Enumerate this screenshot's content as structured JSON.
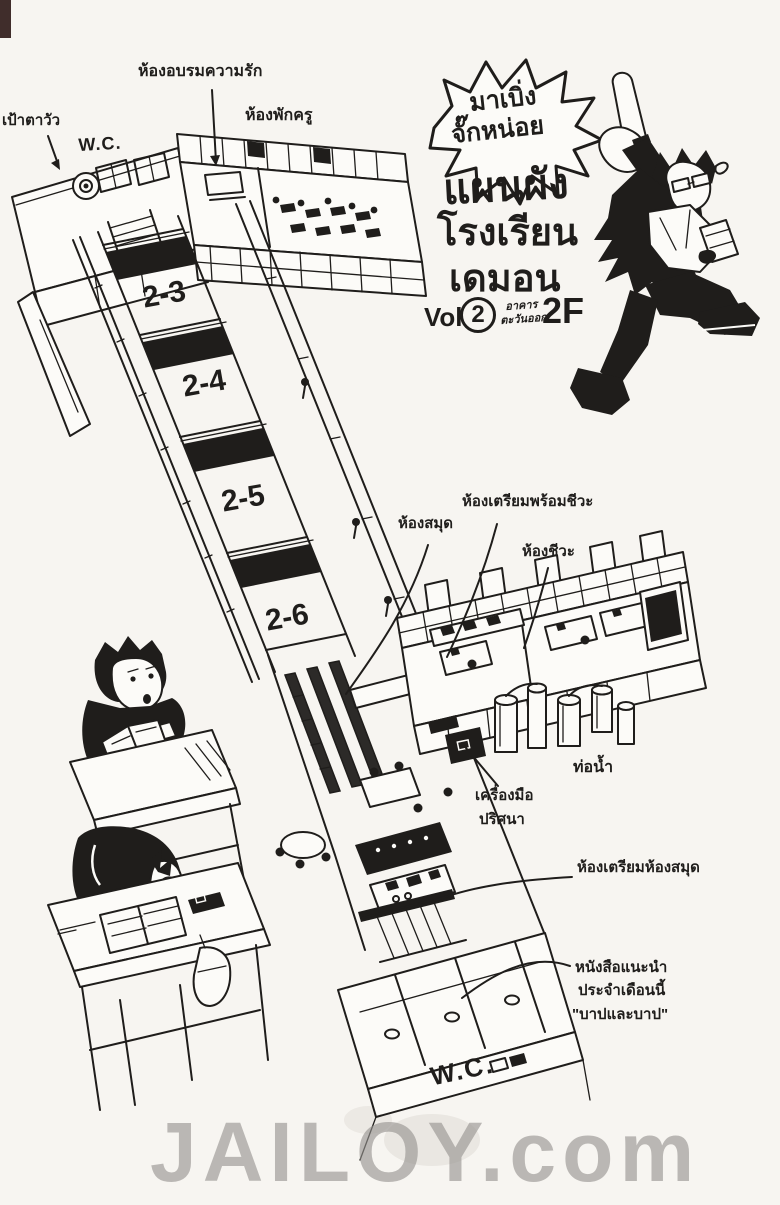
{
  "page": {
    "watermark": "JAILOY.com"
  },
  "title_block": {
    "burst": {
      "line1": "มาเบิ่ง",
      "line2": "จั๊กหน่อย"
    },
    "heading": {
      "line1": "แผนผัง",
      "line2": "โรงเรียน",
      "line3": "เดมอน"
    },
    "volume": {
      "prefix": "Vol.",
      "number": "2",
      "building_line1": "อาคาร",
      "building_line2": "ตะวันออก",
      "floor": "2F"
    }
  },
  "labels": {
    "cow_target": "เป้าตาวัว",
    "wc_top": "W.C.",
    "love_training_room": "ห้องอบรมความรัก",
    "teachers_room": "ห้องพักครู",
    "library": "ห้องสมุด",
    "bio_prep_room": "ห้องเตรียมพร้อมชีวะ",
    "bio_room": "ห้องชีวะ",
    "water_pipes": "ท่อน้ำ",
    "mystery_tools_line1": "เครื่องมือ",
    "mystery_tools_line2": "ปริศนา",
    "library_prep_room": "ห้องเตรียมห้องสมุด",
    "recommended_book_line1": "หนังสือแนะนำ",
    "recommended_book_line2": "ประจำเดือนนี้",
    "recommended_book_line3": "\"บาปและบาป\"",
    "wc_bottom": "W.C."
  },
  "classrooms": [
    "2-3",
    "2-4",
    "2-5",
    "2-6"
  ],
  "colors": {
    "ink": "#1f1d1b",
    "paper": "#f7f5f1",
    "watermark": "#94928e"
  }
}
